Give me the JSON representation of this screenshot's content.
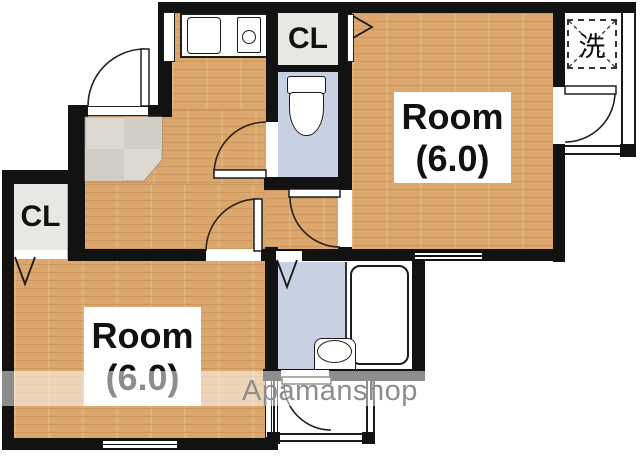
{
  "plan": {
    "watermark_text": "Apamanshop",
    "room_top_right": {
      "name": "Room",
      "size": "(6.0)"
    },
    "room_bottom_left": {
      "name": "Room",
      "size": "(6.0)"
    },
    "closet_top_label": "CL",
    "closet_bottom_label": "CL",
    "laundry_label": "洗",
    "colors": {
      "wall": "#121212",
      "wood_floor": "#dba76c",
      "wet_area_floor": "#c8d1e3",
      "entry_tile": "#ddd8d1",
      "closet_fill": "#e9e7e4",
      "watermark": "#8d8d8d"
    }
  }
}
